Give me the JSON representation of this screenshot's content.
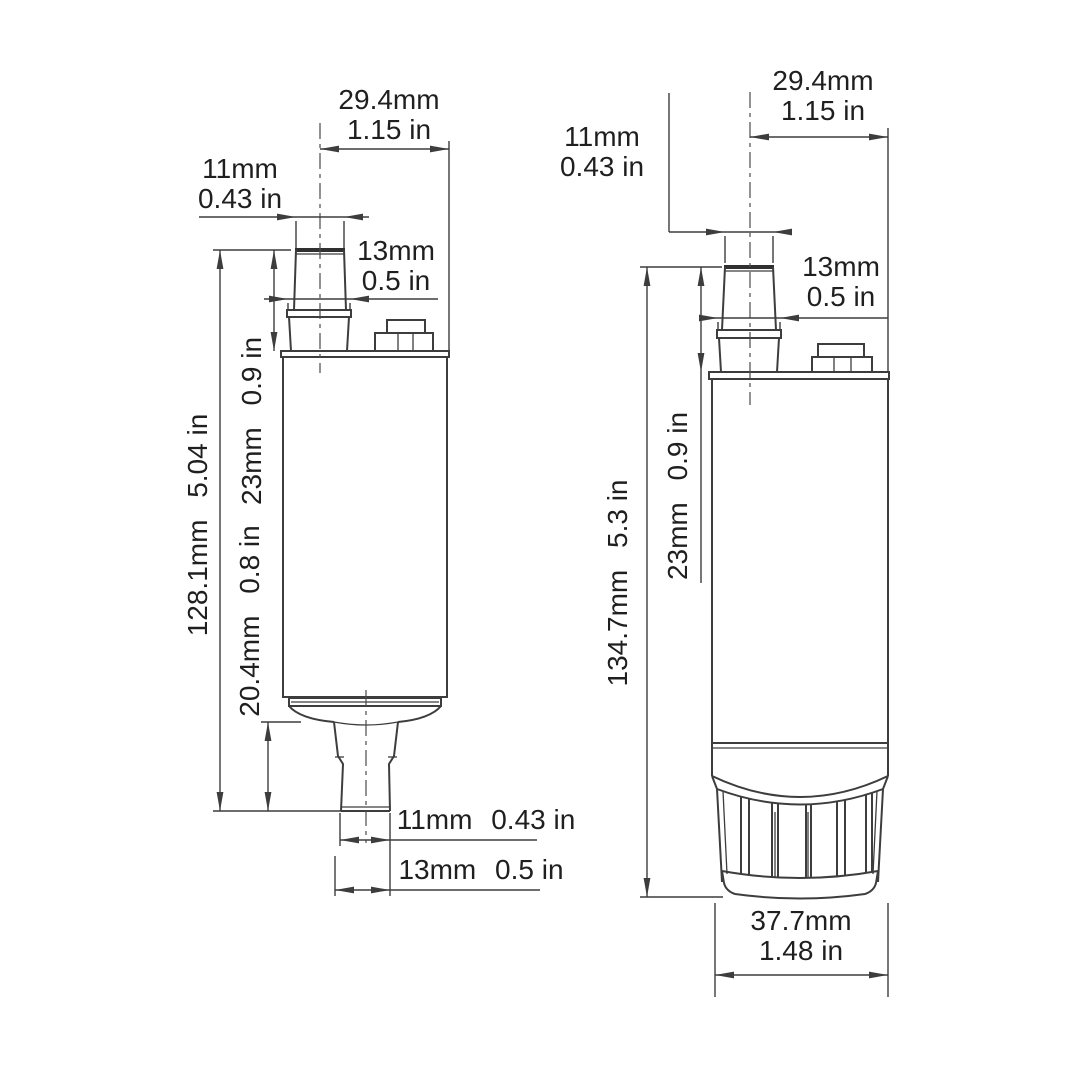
{
  "colors": {
    "background": "#ffffff",
    "line": "#3d3d3d",
    "text": "#1f1f1f"
  },
  "views": {
    "left": {
      "dims": {
        "outlet_od": {
          "mm": "29.4mm",
          "in": "1.15 in"
        },
        "outlet_tip_od": {
          "mm": "11mm",
          "in": "0.43 in"
        },
        "outlet_base_od": {
          "mm": "13mm",
          "in": "0.5 in"
        },
        "overall_height": {
          "mm": "128.1mm",
          "in": "5.04 in"
        },
        "outlet_height": {
          "mm": "23mm",
          "in": "0.9 in"
        },
        "inlet_height": {
          "mm": "20.4mm",
          "in": "0.8 in"
        },
        "inlet_tip_od": {
          "mm": "11mm",
          "in": "0.43 in"
        },
        "inlet_base_od": {
          "mm": "13mm",
          "in": "0.5 in"
        }
      }
    },
    "right": {
      "dims": {
        "outlet_od": {
          "mm": "29.4mm",
          "in": "1.15 in"
        },
        "outlet_tip_od": {
          "mm": "11mm",
          "in": "0.43 in"
        },
        "outlet_base_od": {
          "mm": "13mm",
          "in": "0.5 in"
        },
        "overall_height": {
          "mm": "134.7mm",
          "in": "5.3 in"
        },
        "outlet_height": {
          "mm": "23mm",
          "in": "0.9 in"
        },
        "strainer_od": {
          "mm": "37.7mm",
          "in": "1.48 in"
        }
      }
    }
  }
}
